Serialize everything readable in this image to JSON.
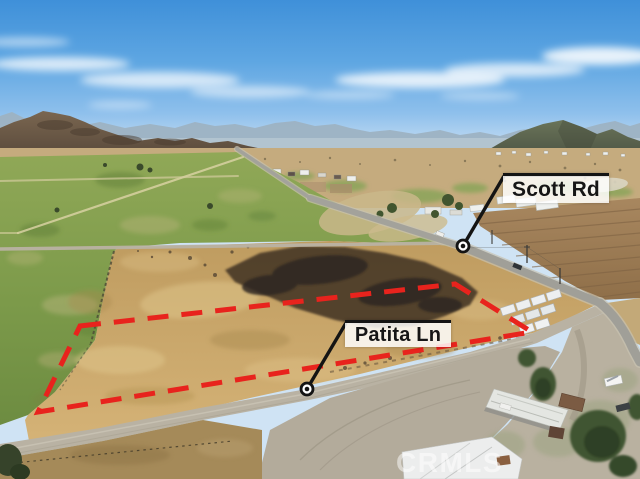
{
  "photo": {
    "type": "aerial drone photograph",
    "scene": "vacant dirt land parcel outlined with a red dashed boundary, green pasture fields on the left, burnt dark scrub in the parcel, rural roads, farm buildings, storage containers and mountains on the horizon",
    "sky": "blue sky with wispy white clouds"
  },
  "annotations": {
    "boundary": {
      "style": "dashed",
      "color": "#e8231d"
    },
    "labels": [
      {
        "id": "scott-rd",
        "text": "Scott Rd"
      },
      {
        "id": "patita-ln",
        "text": "Patita Ln"
      }
    ]
  },
  "watermark": {
    "text": "CRMLS"
  }
}
